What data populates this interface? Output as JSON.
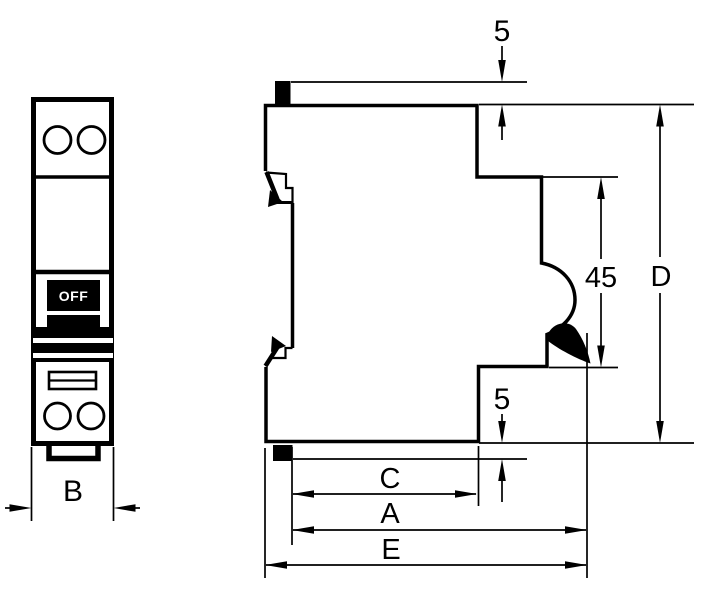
{
  "drawing": {
    "description": "Dimensional drawing of a single-module miniature circuit breaker: front view and side profile view",
    "colors": {
      "ink": "#000000",
      "paper": "#ffffff"
    }
  },
  "labels": {
    "off": "OFF",
    "dim_b": "B",
    "dim_top_5": "5",
    "dim_45": "45",
    "dim_d": "D",
    "dim_bottom_5": "5",
    "dim_c": "C",
    "dim_a": "A",
    "dim_e": "E"
  }
}
